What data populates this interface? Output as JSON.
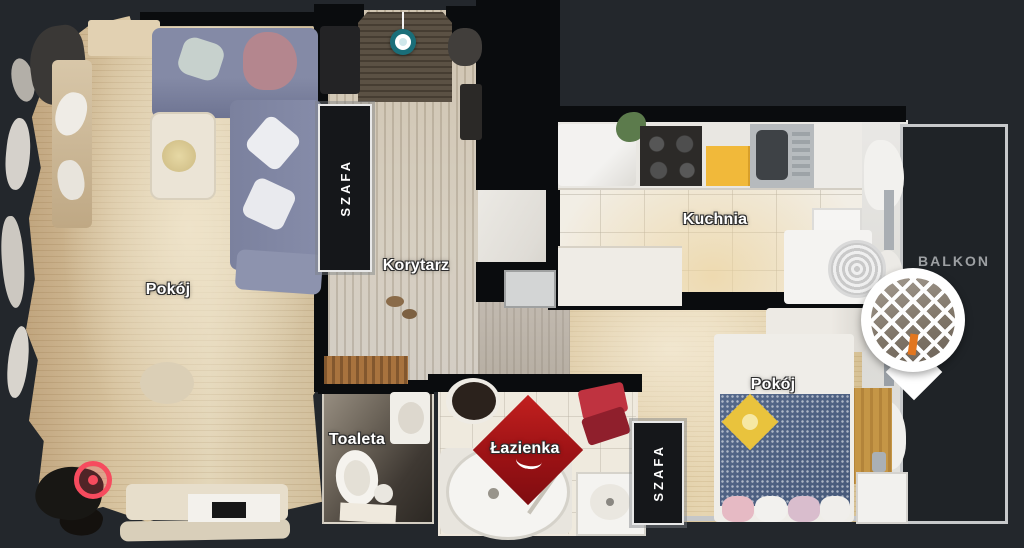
{
  "scene": {
    "background": "#23272c",
    "void_color": "#0a0c0e",
    "wall_color": "#0a0c0e",
    "accent_red": "#f64b5e",
    "accent_teal": "#1a6e79",
    "label_color": "#ffffff",
    "balcony_label_color": "#9da0a3"
  },
  "labels": {
    "living_room": "Pokój",
    "corridor": "Korytarz",
    "kitchen": "Kuchnia",
    "toilet": "Toaleta",
    "bathroom": "Łazienka",
    "bedroom": "Pokój",
    "closet_top": "SZAFA",
    "closet_bottom": "SZAFA",
    "balcony": "BALKON"
  },
  "markers": {
    "camera_sweep": {
      "name": "camera-sweep-marker",
      "color": "#1a6e79"
    },
    "current_position": {
      "name": "current-position-marker",
      "color": "#f64b5e"
    },
    "balcony_pin": {
      "name": "balcony-view-pin"
    }
  }
}
